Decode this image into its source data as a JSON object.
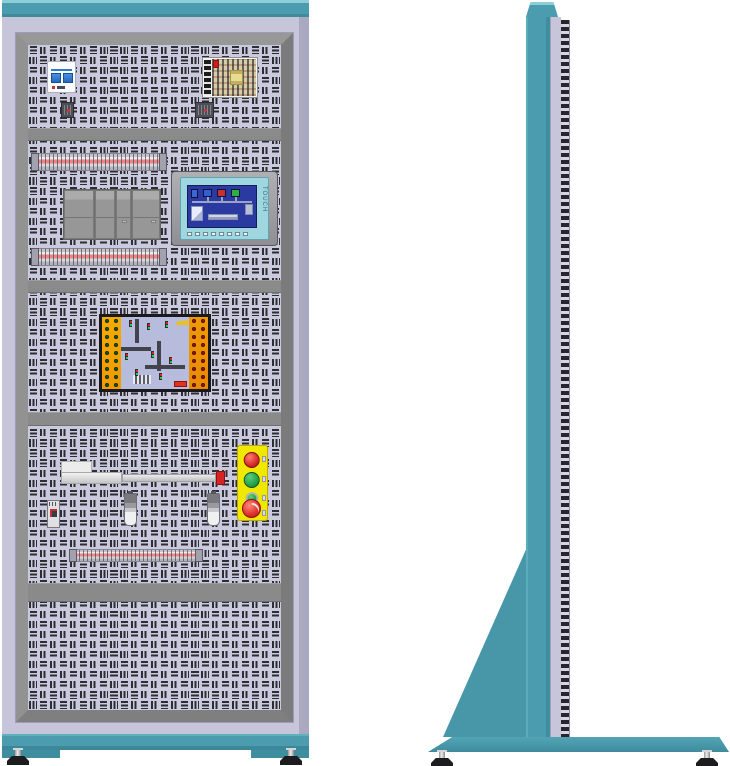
{
  "title": "Electrical control training cabinet - front and side views",
  "hmi": {
    "side_label": "TOUCH"
  },
  "views": {
    "front": {
      "sections": [
        {
          "name": "power-section",
          "components": [
            "residual-current-circuit-breaker",
            "switching-power-supply",
            "wiring-connector",
            "wiring-connector"
          ]
        },
        {
          "name": "controller-section",
          "components": [
            "terminal-strip",
            "plc-controller",
            "hmi-touch-panel",
            "terminal-strip"
          ]
        },
        {
          "name": "simulation-section",
          "components": [
            "traffic-intersection-simulation-board"
          ]
        },
        {
          "name": "actuator-section",
          "components": [
            "pneumatic-cylinder",
            "mini-relay",
            "proximity-sensor",
            "proximity-sensor",
            "push-button-station",
            "terminal-strip"
          ]
        },
        {
          "name": "blank-section",
          "components": []
        }
      ]
    },
    "side": {
      "components": [
        "top-cap",
        "cabinet-column",
        "perforated-panel-edge",
        "support-brace",
        "base-plate",
        "leveling-foot",
        "leveling-foot"
      ]
    }
  },
  "push_button_station": {
    "buttons": [
      "push-button-red",
      "push-button-green",
      "push-button-green",
      "emergency-stop-mushroom"
    ],
    "button_colors": [
      "#d42424",
      "#1e9e44",
      "#1e9e44",
      "#de3030"
    ],
    "box_color": "#f0e800"
  },
  "simulation_board": {
    "left_terminals": {
      "count": 18,
      "color": "#186030"
    },
    "right_terminals": {
      "count": 18,
      "color": "#a81818"
    },
    "strip_color": "#f4a500",
    "center_color": "#b7bcdc"
  },
  "palette": {
    "teal": "#4a9cae",
    "teal_light": "#8ccdd6",
    "teal_dark": "#3e8b9c",
    "lavender": "#c7c5da",
    "bezel_gray": "#8a8a8a",
    "perforation_slot": "#2d2d34",
    "perforation_bg": "#cbc9dd",
    "screen_blue": "#2a3aa0",
    "hmi_frame_cyan": "#9ed7e0",
    "terminal_strip_red": "#ee8484"
  }
}
